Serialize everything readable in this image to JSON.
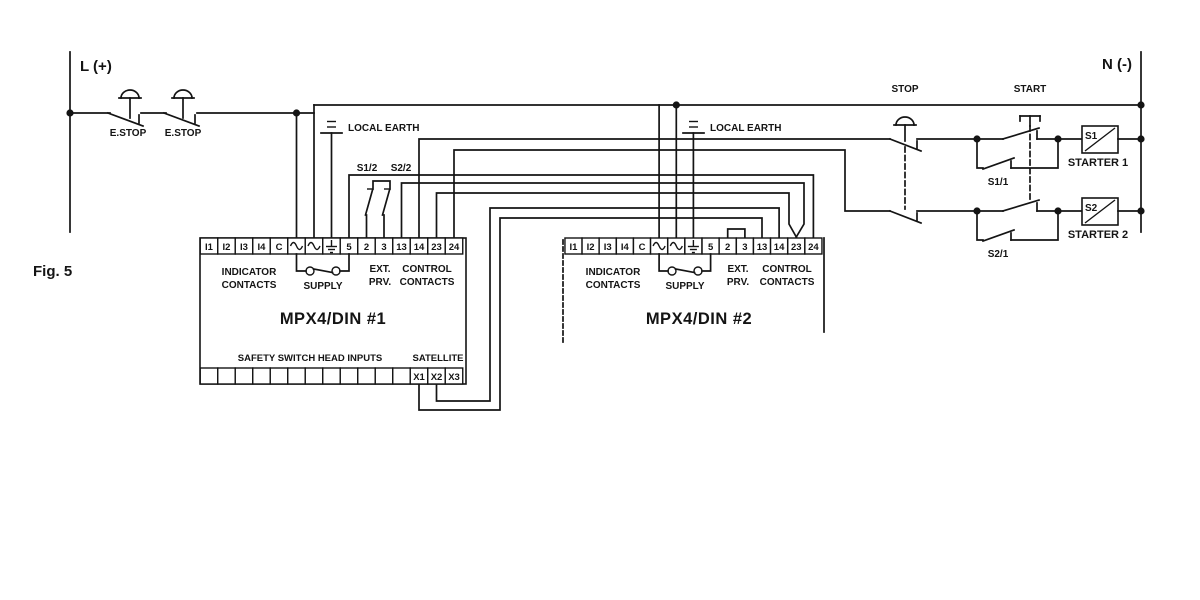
{
  "figure": {
    "label": "Fig. 5"
  },
  "power": {
    "line_label": "L (+)",
    "neutral_label": "N (-)"
  },
  "emergency_stops": [
    {
      "label": "E.STOP"
    },
    {
      "label": "E.STOP"
    }
  ],
  "controls": {
    "stop_label": "STOP",
    "start_label": "START"
  },
  "units": [
    {
      "title": "MPX4/DIN #1",
      "terminals": [
        "I1",
        "I2",
        "I3",
        "I4",
        "C",
        "~",
        "~",
        "⏚",
        "5",
        "2",
        "3",
        "13",
        "14",
        "23",
        "24"
      ],
      "sections": {
        "indicator_line1": "INDICATOR",
        "indicator_line2": "CONTACTS",
        "supply": "SUPPLY",
        "ext_line1": "EXT.",
        "ext_line2": "PRV.",
        "control_line1": "CONTROL",
        "control_line2": "CONTACTS"
      },
      "earth_label": "LOCAL EARTH",
      "aux_contacts": [
        {
          "label": "S1/2"
        },
        {
          "label": "S2/2"
        }
      ],
      "bottom": {
        "inputs_label": "SAFETY SWITCH HEAD INPUTS",
        "satellite_label": "SATELLITE",
        "satellite_terminals": [
          "X1",
          "X2",
          "X3"
        ]
      }
    },
    {
      "title": "MPX4/DIN #2",
      "terminals": [
        "I1",
        "I2",
        "I3",
        "I4",
        "C",
        "~",
        "~",
        "⏚",
        "5",
        "2",
        "3",
        "13",
        "14",
        "23",
        "24"
      ],
      "sections": {
        "indicator_line1": "INDICATOR",
        "indicator_line2": "CONTACTS",
        "supply": "SUPPLY",
        "ext_line1": "EXT.",
        "ext_line2": "PRV.",
        "control_line1": "CONTROL",
        "control_line2": "CONTACTS"
      },
      "earth_label": "LOCAL EARTH"
    }
  ],
  "starters": [
    {
      "box_label": "S1",
      "name": "STARTER 1",
      "seal_contact": "S1/1"
    },
    {
      "box_label": "S2",
      "name": "STARTER 2",
      "seal_contact": "S2/1"
    }
  ],
  "colors": {
    "line": "#141414",
    "background": "#ffffff"
  }
}
